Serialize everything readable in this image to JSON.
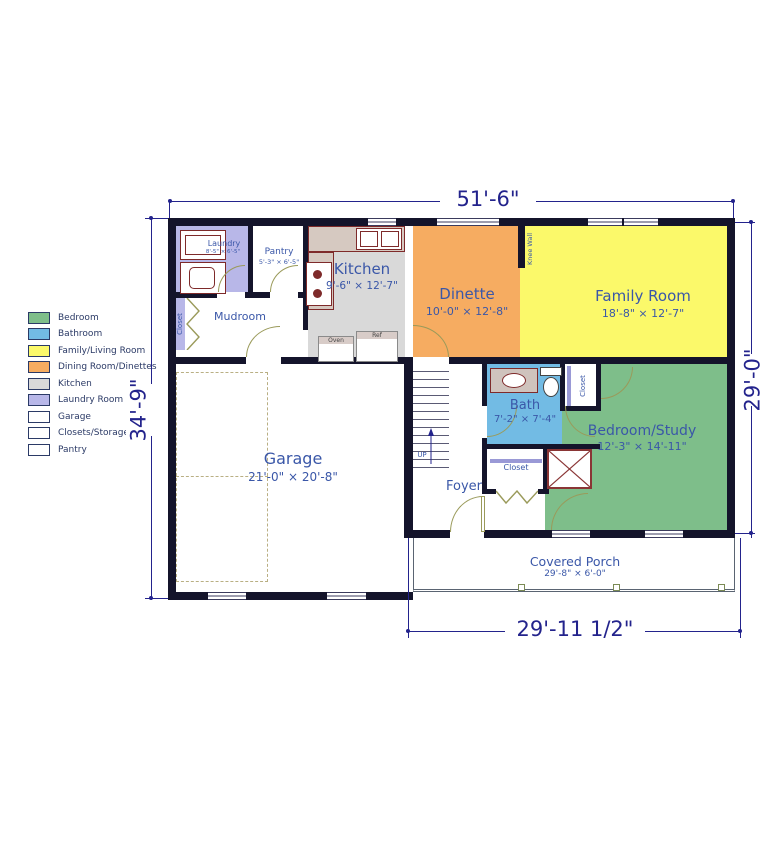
{
  "palette": {
    "wall": "#14142B",
    "dimension": "#23238C",
    "room_label": "#3A57A8",
    "door": "#9a9a5a",
    "counter_outline": "#7E2A2A"
  },
  "dims": {
    "top": "51'-6\"",
    "left": "34'-9\"",
    "right": "29'-0\"",
    "bottom": "29'-11 1/2\""
  },
  "legend": {
    "items": [
      {
        "label": "Bedroom",
        "color": "#7EBE8A"
      },
      {
        "label": "Bathroom",
        "color": "#72BBE4"
      },
      {
        "label": "Family/Living Room",
        "color": "#FBF96A"
      },
      {
        "label": "Dining Room/Dinettes",
        "color": "#F6AC61"
      },
      {
        "label": "Kitchen",
        "color": "#D9D9D9"
      },
      {
        "label": "Laundry Room",
        "color": "#B8B7E8"
      },
      {
        "label": "Garage",
        "color": "#FFFFFF"
      },
      {
        "label": "Closets/Storage",
        "color": "#FFFFFF"
      },
      {
        "label": "Pantry",
        "color": "#FFFFFF"
      }
    ]
  },
  "rooms": {
    "laundry": {
      "name": "Laundry",
      "size": "8'-5\" × 6'-5\"",
      "color": "#B8B7E8"
    },
    "pantry": {
      "name": "Pantry",
      "size": "5'-3\" × 6'-5\"",
      "color": "#FFFFFF"
    },
    "mudroom": {
      "name": "Mudroom",
      "color": "#FFFFFF"
    },
    "kitchen": {
      "name": "Kitchen",
      "size": "9'-6\" × 12'-7\"",
      "color": "#D9D9D9"
    },
    "dinette": {
      "name": "Dinette",
      "size": "10'-0\" × 12'-8\"",
      "color": "#F6AC61"
    },
    "family_room": {
      "name": "Family Room",
      "size": "18'-8\" × 12'-7\"",
      "color": "#FBF96A"
    },
    "bath": {
      "name": "Bath",
      "size": "7'-2\" × 7'-4\"",
      "color": "#72BBE4"
    },
    "bedroom_study": {
      "name": "Bedroom/Study",
      "size": "12'-3\" × 14'-11\"",
      "color": "#7EBE8A"
    },
    "garage": {
      "name": "Garage",
      "size": "21'-0\" × 20'-8\"",
      "color": "#FFFFFF"
    },
    "foyer": {
      "name": "Foyer",
      "color": "#FFFFFF"
    },
    "covered_porch": {
      "name": "Covered Porch",
      "size": "29'-8\" × 6'-0\"",
      "color": "#FFFFFF"
    }
  },
  "annotations": {
    "knee_wall": "Knee Wall",
    "closet": "Closet",
    "up": "UP",
    "oven": "Oven",
    "ref": "Ref"
  }
}
